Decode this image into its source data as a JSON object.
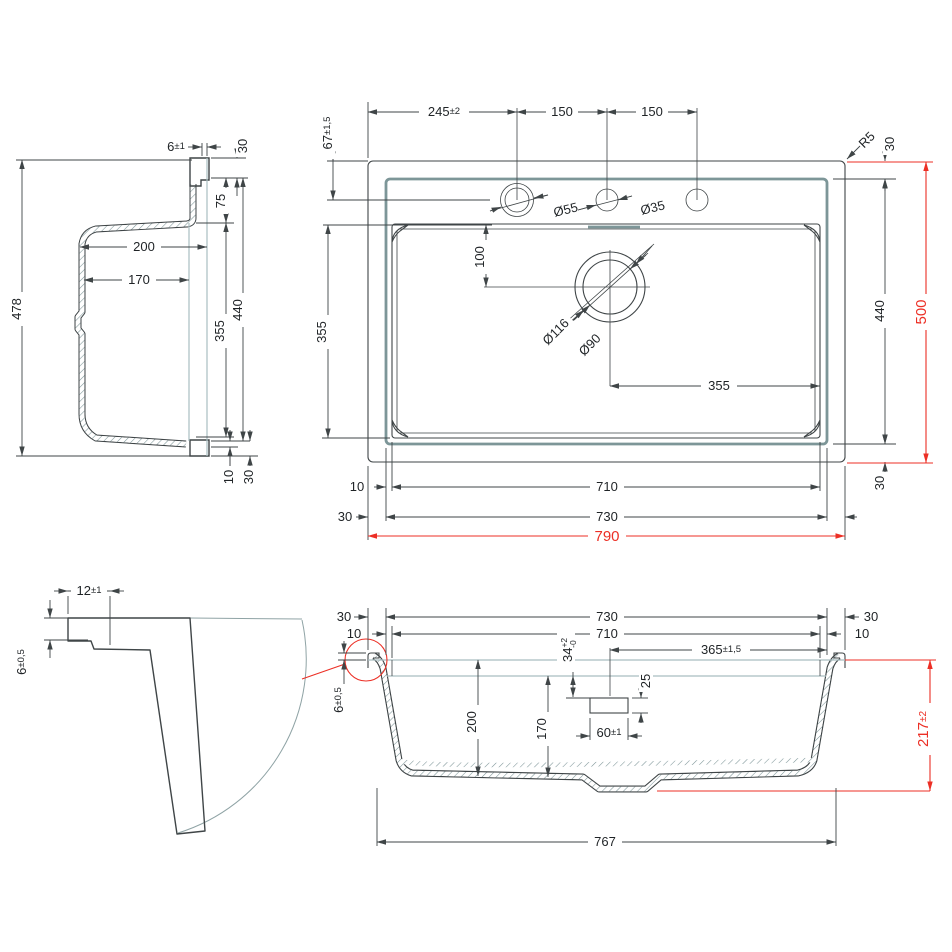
{
  "drawing_type": "sink technical drawing, four dimensioned views",
  "colors": {
    "line": "#3f4547",
    "steel": "#7d9698",
    "light_steel": "#a9bec1",
    "hatch": "#7d9598",
    "accent_red": "#ec2f25",
    "text": "#1f2326",
    "background": "#ffffff"
  },
  "dims": {
    "side": {
      "d6_v": "6",
      "d6_t": "±1",
      "d30_top": "30",
      "d75": "75",
      "d200": "200",
      "d170": "170",
      "d355": "355",
      "d440": "440",
      "d478": "478",
      "d10": "10",
      "d30_bot": "30"
    },
    "top": {
      "d245_v": "245",
      "d245_t": "±2",
      "d150_a": "150",
      "d150_b": "150",
      "d67_v": "67",
      "d67_t": "±1,5",
      "dR5": "R5",
      "d30_tr": "30",
      "d55": "Ø55",
      "d35": "Ø35",
      "d100": "100",
      "d355_left": "355",
      "d116": "Ø116",
      "d90": "Ø90",
      "d355_drain": "355",
      "d440": "440",
      "d500": "500",
      "d10": "10",
      "d710": "710",
      "d30_bl": "30",
      "d730": "730",
      "d790": "790",
      "d30_br": "30"
    },
    "detail": {
      "d12_v": "12",
      "d12_t": "±1",
      "d6_v": "6",
      "d6_t": "±0,5"
    },
    "section": {
      "d30_l": "30",
      "d730": "730",
      "d30_r": "30",
      "d10_l": "10",
      "d710": "710",
      "d10_r": "10",
      "d34_v": "34",
      "d34_up": "+2",
      "d34_dn": "-0",
      "d365_v": "365",
      "d365_t": "±1,5",
      "d25": "25",
      "d6_v": "6",
      "d6_t": "±0,5",
      "d200": "200",
      "d170": "170",
      "d60_v": "60",
      "d60_t": "±1",
      "d217_v": "217",
      "d217_t": "±2",
      "d767": "767"
    }
  }
}
